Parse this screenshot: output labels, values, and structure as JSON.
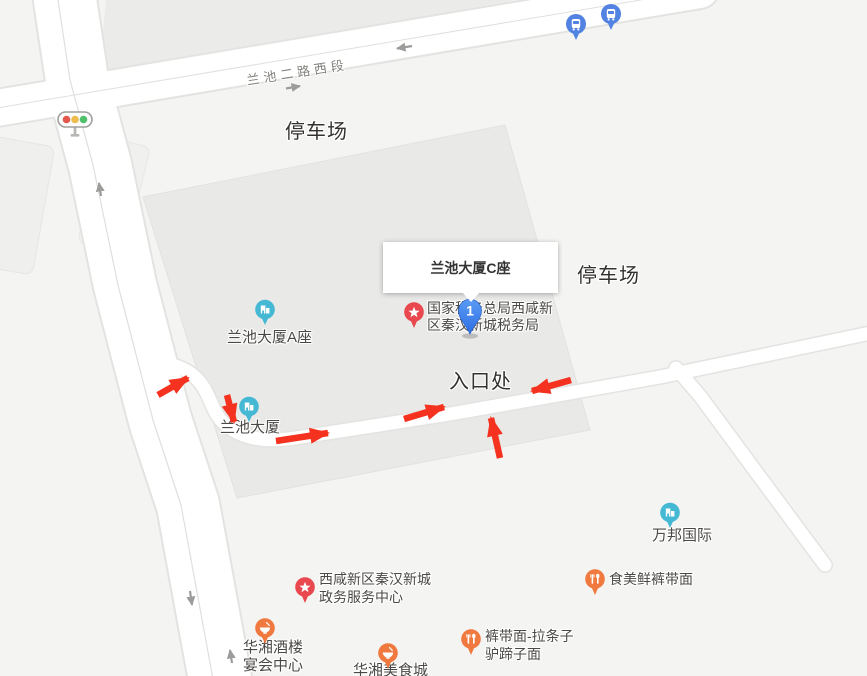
{
  "window": {
    "width": 867,
    "height": 676,
    "app": "web-map-view"
  },
  "colors": {
    "background": "#f4f4f2",
    "parcel": "#e9e9e7",
    "road": "#ffffff",
    "road_casing": "#e3e3e1",
    "route_arrow_red": "#f5321f",
    "poi_building_teal": "#45b8d4",
    "poi_government_red": "#e8484e",
    "poi_restaurant_orange": "#f0793f",
    "bus_stop_blue": "#5282e2",
    "destination_marker_blue": "#3b7de8",
    "area_label_dark": "#33312d",
    "poi_label_gray": "#4b4947",
    "road_label_gray": "#82807c"
  },
  "road_label": "兰池二路西段",
  "area_labels": {
    "parking_top": "停车场",
    "parking_right": "停车场",
    "entrance": "入口处"
  },
  "popup": {
    "title": "兰池大厦C座"
  },
  "route_marker": {
    "number": "1"
  },
  "pois": {
    "tax_office": {
      "line1": "国家税务总局西咸新",
      "line2": "区秦汉新城税务局"
    },
    "lanchi_a": {
      "name": "兰池大厦A座"
    },
    "lanchi": {
      "name": "兰池大厦"
    },
    "wanbang": {
      "name": "万邦国际"
    },
    "gov_center": {
      "line1": "西咸新区秦汉新城",
      "line2": "政务服务中心"
    },
    "shimei": {
      "name": "食美鲜裤带面"
    },
    "kudaimian": {
      "line1": "裤带面-拉条子",
      "line2": "驴蹄子面"
    },
    "huaxiang_hotel": {
      "line1": "华湘酒楼",
      "line2": "宴会中心"
    },
    "huaxiang_food": {
      "name": "华湘美食城"
    }
  },
  "icons": {
    "bus_stop": "bus-stop-icon",
    "traffic_light": "traffic-light-icon",
    "building": "building-pin-icon",
    "government": "star-pin-icon",
    "restaurant_fork": "fork-knife-pin-icon",
    "restaurant_bowl": "bowl-pin-icon"
  }
}
